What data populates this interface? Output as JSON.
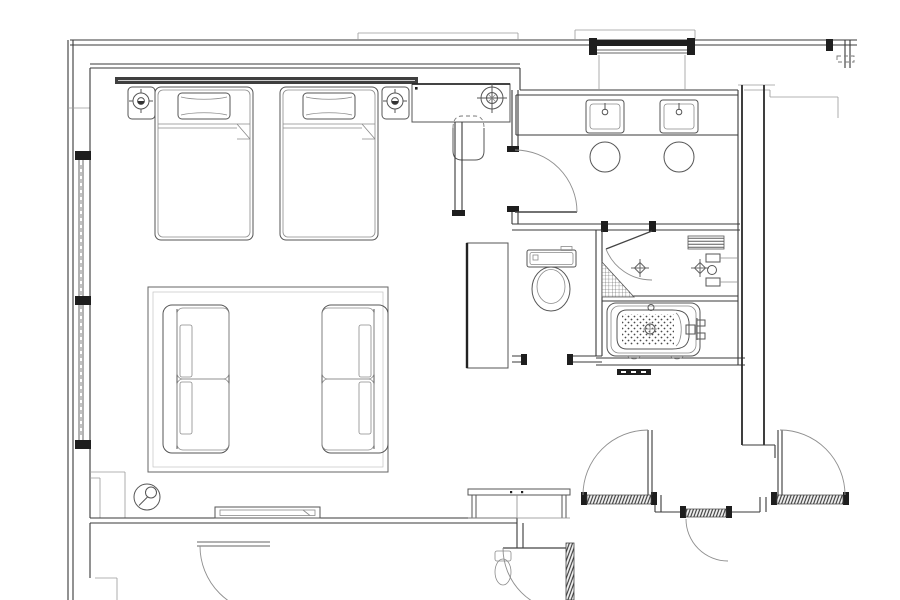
{
  "document": {
    "label": "hotel guest room floor plan",
    "type": "architectural floor plan (CAD line drawing)",
    "background_color": "#ffffff",
    "line_color": "#3a3a3a",
    "accent_black": "#1e1e1e",
    "visible_text": "none"
  },
  "rooms": [
    {
      "name": "bedroom",
      "furniture": [
        "twin-bed-left",
        "twin-bed-right",
        "pillow-left",
        "pillow-right",
        "headboard-wall-panel",
        "nightstand-left",
        "nightstand-right",
        "table-lamp-left",
        "table-lamp-right",
        "desk",
        "desk-lamp",
        "desk-chair",
        "area-rug",
        "sofa-left-facing-right",
        "sofa-right-facing-left",
        "floor-lamp",
        "wall-console-shelf"
      ],
      "windows": [
        "left-wall-window-with-mullions"
      ]
    },
    {
      "name": "vanity-room",
      "fixtures": [
        "vanity-counter",
        "sink-left",
        "sink-right",
        "stool-left",
        "stool-right",
        "swing-door-from-bedroom"
      ],
      "windows": [
        "top-wall-window"
      ]
    },
    {
      "name": "toilet-room",
      "fixtures": [
        "toilet-with-tank",
        "door-opening-bottom"
      ]
    },
    {
      "name": "shower-room",
      "fixtures": [
        "glass-swing-door",
        "floor-drain-left",
        "floor-drain-right",
        "tiled-corner-slope",
        "shower-valves",
        "shelf-niche"
      ]
    },
    {
      "name": "bath-room",
      "fixtures": [
        "bathtub",
        "anti-slip-dot-mat",
        "tub-drain",
        "tub-overflow",
        "tub-filler-and-handles",
        "tub-feet",
        "threshold-saddle"
      ]
    },
    {
      "name": "closet",
      "fixtures": [
        "tall-wardrobe-cabinet"
      ]
    },
    {
      "name": "entry-vestibule",
      "fixtures": [
        "luggage-bench",
        "entry-swing-door"
      ]
    },
    {
      "name": "corridor",
      "fixtures": [
        "neighbor-door-left",
        "service-door-center",
        "neighbor-door-right",
        "door-thresholds-hatched"
      ]
    },
    {
      "name": "adjacent-room-below",
      "fixtures": [
        "swing-door-lower-left",
        "swing-door-lower-center",
        "door-jamb-hatched",
        "partial-fixture"
      ]
    }
  ],
  "architecture": {
    "walls": "double parallel lines, poche-free",
    "windows": [
      "left-exterior-window",
      "top-exterior-window",
      "top-right-window-fragment"
    ],
    "door_count_visible": 8,
    "hatching": [
      "door-thresholds",
      "shower-corner",
      "shelf-niche",
      "jamb-bars"
    ]
  }
}
